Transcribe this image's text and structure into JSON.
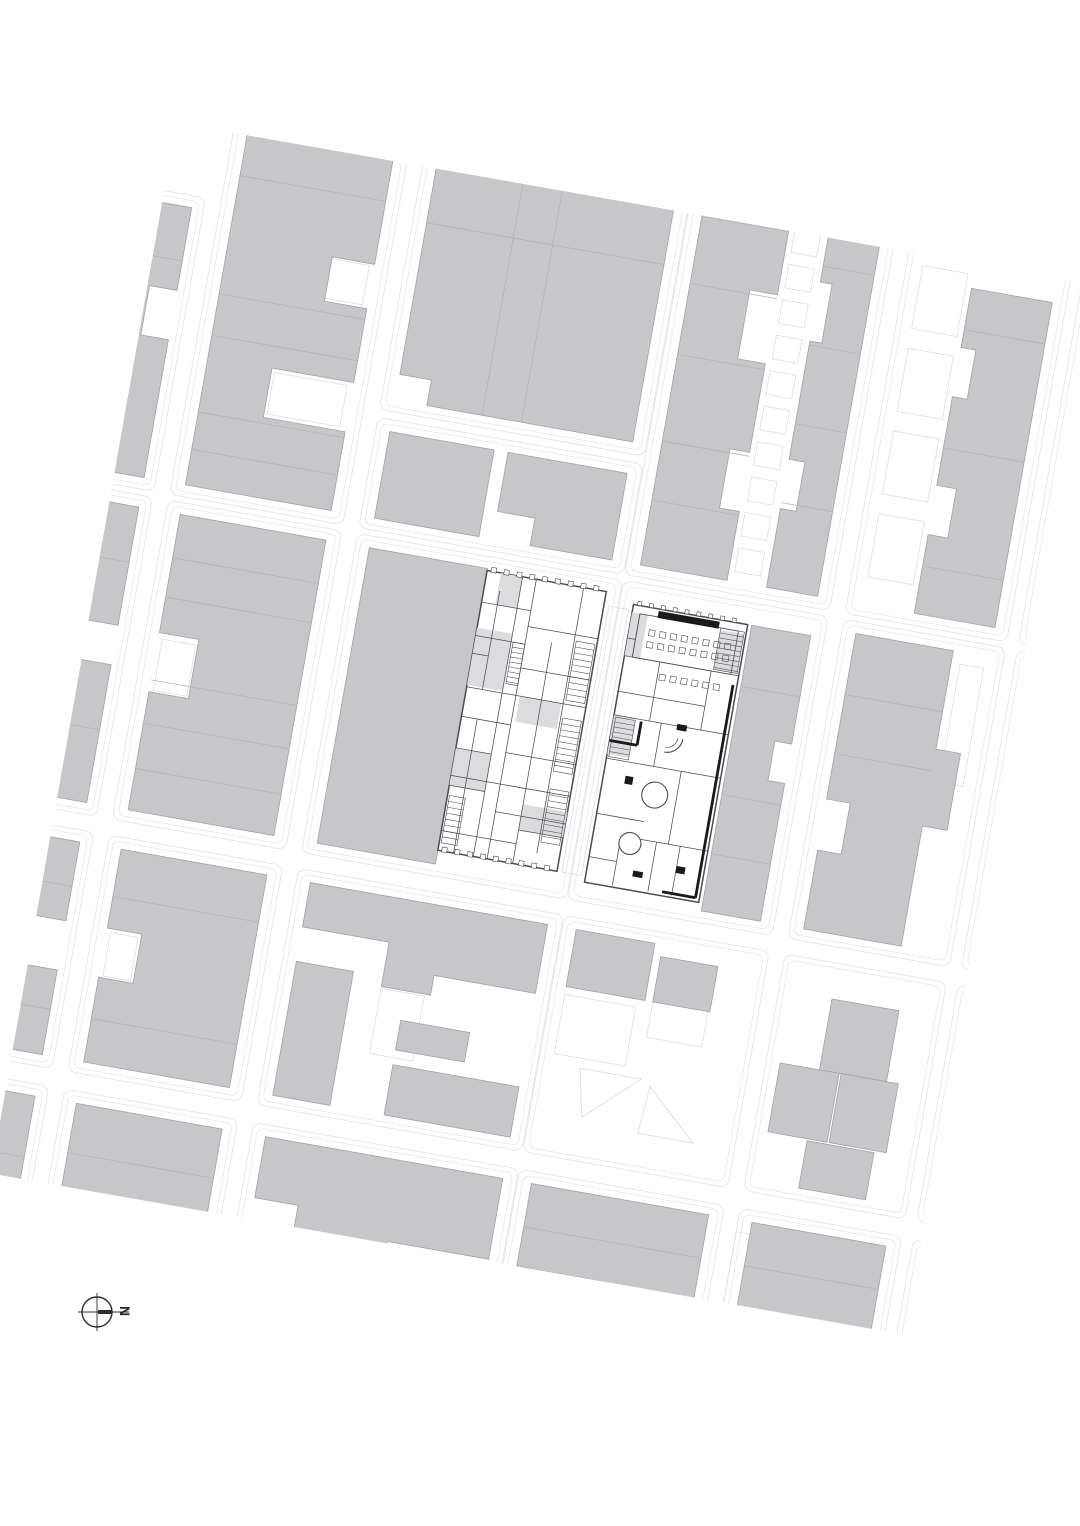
{
  "north_arrow": {
    "label": "N",
    "cx": 97,
    "cy": 1312,
    "r": 15,
    "cross_ext": 19,
    "thick_len": 15
  },
  "palette": {
    "background": "#ffffff",
    "block_fill": "#c7c7ca",
    "block_stroke": "#a2a2a8",
    "divider": "#b2b2b7",
    "street_line": "#e7e7ea",
    "parcel_line": "#dddde1",
    "plan_line": "#4b4b52",
    "plan_heavy": "#1a1a1a",
    "plan_shade": "#dcdcdf",
    "arrow": "#2e2e2e"
  },
  "map": {
    "clip": [
      78,
      195,
      928,
      1067
    ],
    "rotation": {
      "deg": 10,
      "cx": 540,
      "cy": 720
    },
    "outlines": [
      [
        -62,
        264,
        182,
        298
      ],
      [
        -62,
        568,
        182,
        324
      ],
      [
        -62,
        908,
        182,
        240
      ],
      [
        -62,
        1166,
        182,
        246
      ],
      [
        136,
        48,
        176,
        514
      ],
      [
        136,
        568,
        176,
        324
      ],
      [
        136,
        908,
        176,
        240
      ],
      [
        136,
        1166,
        176,
        246
      ],
      [
        328,
        48,
        269,
        394
      ],
      [
        328,
        450,
        269,
        112
      ],
      [
        328,
        568,
        269,
        324
      ],
      [
        328,
        908,
        269,
        240
      ],
      [
        328,
        1166,
        269,
        246
      ],
      [
        598,
        48,
        208,
        514
      ],
      [
        598,
        568,
        208,
        324
      ],
      [
        598,
        908,
        208,
        240
      ],
      [
        598,
        1166,
        208,
        246
      ],
      [
        822,
        48,
        164,
        514
      ],
      [
        822,
        568,
        164,
        324
      ],
      [
        822,
        908,
        164,
        240
      ],
      [
        822,
        1166,
        164,
        246
      ],
      [
        998,
        48,
        186,
        514
      ],
      [
        998,
        568,
        186,
        324
      ],
      [
        998,
        908,
        186,
        240
      ],
      [
        998,
        1166,
        186,
        246
      ]
    ],
    "parcels": [
      [
        233,
        302,
        60,
        40
      ],
      [
        218,
        424,
        74,
        42
      ],
      [
        154,
        706,
        34,
        52
      ],
      [
        154,
        1004,
        28,
        44
      ],
      [
        430,
        1012,
        44,
        66
      ],
      [
        588,
        596,
        20,
        270
      ],
      [
        944,
        592,
        24,
        120
      ],
      [
        1016,
        338,
        148,
        44
      ],
      [
        1012,
        766,
        96,
        108
      ],
      [
        822,
        1190,
        60,
        100
      ],
      [
        700,
        954,
        56,
        60
      ],
      [
        612,
        986,
        72,
        60
      ]
    ],
    "parcel_rows": [
      {
        "x": 706,
        "y0": 84,
        "count": 13,
        "step": 36,
        "w": 26,
        "h": 24
      },
      {
        "x": 838,
        "y0": 206,
        "count": 4,
        "step": 84,
        "w": 46,
        "h": 64
      }
    ],
    "parcel_polys": [
      "640,1056 702,1056 650,1104",
      "712,1062 764,1110 708,1110"
    ],
    "buildings": [
      "-50,276 108,276 108,360 80,360 80,410 108,410 108,550 -50,550",
      "-50,580 108,580 108,700 60,700 60,740 108,740 108,880 -50,880",
      "-50,920 108,920 108,1000 70,1000 70,1050 108,1050 108,1136 -50,1136",
      [
        -50,
        1178,
        158,
        222
      ],
      [
        150,
        60,
        148,
        110
      ],
      "150,190 298,190 298,300 255,300 255,345 298,345 298,420 215,420 215,470 298,470 298,550 150,550",
      "150,580 298,580 298,880 150,880 150,760 190,760 190,700 150,700",
      "150,920 298,920 298,1136 150,1136 150,1050 185,1050 185,1000 150,1000",
      [
        150,
        1178,
        148,
        222
      ],
      "342,60 583,60 583,430 374,430 374,404 342,404",
      [
        342,
        462,
        106,
        88
      ],
      "462,462 583,462 583,550 500,550 500,522 462,522",
      [
        342,
        580,
        120,
        300
      ],
      "342,920 583,920 583,990 480,990 480,1010 430,1010 430,965 342,965",
      [
        342,
        1000,
        58,
        136
      ],
      [
        455,
        1085,
        128,
        51
      ],
      [
        455,
        1040,
        70,
        30
      ],
      "342,1178 583,1178 583,1260 480,1260 480,1320 386,1320 386,1240 342,1240",
      [
        500,
        1298,
        83,
        102
      ],
      "612,60 700,60 700,120 680,120 680,180 700,180 700,260 672,260 672,330 700,330 700,420 680,420 680,480 700,480 700,550 612,550",
      "740,60 792,60 792,550 740,550 740,470 756,470 756,420 740,420 740,300 752,300 752,240 740,240",
      "732,590 792,590 792,700 775,700 775,740 792,740 792,880 732,880",
      [
        612,
        920,
        80,
        58
      ],
      [
        700,
        932,
        58,
        46
      ],
      "612,1178 792,1178 792,1310 700,1310 700,1262 612,1262",
      [
        648,
        1310,
        144,
        90
      ],
      [
        836,
        60,
        136,
        128
      ],
      "890,220 972,220 972,550 890,550 890,470 910,470 910,420 890,420 890,330 905,330 905,280 890,280",
      "836,580 935,580 935,680 960,680 960,758 935,758 935,880 836,880 836,800 860,800 860,748 836,748",
      [
        876,
        944,
        68,
        72
      ],
      [
        836,
        1016,
        60,
        70
      ],
      [
        898,
        1016,
        58,
        70
      ],
      [
        876,
        1088,
        68,
        48
      ],
      [
        836,
        1178,
        136,
        118
      ],
      [
        1012,
        60,
        158,
        268
      ],
      [
        1012,
        390,
        158,
        160
      ],
      [
        1012,
        580,
        110,
        178
      ],
      "1012,920 1170,920 1170,1136 1012,1136 1012,1060 1040,1060 1040,1010 1012,1010",
      [
        1040,
        1178,
        130,
        140
      ]
    ],
    "white_cuts": [
      [
        488,
        172,
        74,
        20
      ]
    ],
    "dividers": [
      [
        -50,
        330,
        108,
        330
      ],
      [
        -50,
        636,
        108,
        636
      ],
      [
        -50,
        806,
        108,
        806
      ],
      [
        -50,
        965,
        108,
        965
      ],
      [
        -50,
        1090,
        108,
        1090
      ],
      [
        -50,
        1240,
        108,
        1240
      ],
      [
        -50,
        1300,
        108,
        1300
      ],
      [
        150,
        110,
        298,
        110
      ],
      [
        150,
        152,
        298,
        152
      ],
      [
        150,
        236,
        298,
        236
      ],
      [
        150,
        356,
        298,
        356
      ],
      [
        150,
        398,
        298,
        398
      ],
      [
        150,
        476,
        298,
        476
      ],
      [
        150,
        514,
        298,
        514
      ],
      [
        150,
        624,
        298,
        624
      ],
      [
        150,
        664,
        298,
        664
      ],
      [
        150,
        748,
        298,
        748
      ],
      [
        150,
        792,
        298,
        792
      ],
      [
        150,
        838,
        298,
        838
      ],
      [
        150,
        968,
        298,
        968
      ],
      [
        150,
        1092,
        298,
        1092
      ],
      [
        150,
        1228,
        298,
        1228
      ],
      [
        150,
        1286,
        298,
        1286
      ],
      [
        430,
        60,
        430,
        430
      ],
      [
        500,
        60,
        500,
        170
      ],
      [
        470,
        196,
        470,
        430
      ],
      [
        342,
        250,
        583,
        250
      ],
      [
        612,
        152,
        700,
        152
      ],
      [
        612,
        196,
        700,
        196
      ],
      [
        612,
        264,
        700,
        264
      ],
      [
        612,
        336,
        700,
        336
      ],
      [
        612,
        424,
        700,
        424
      ],
      [
        612,
        484,
        700,
        484
      ],
      [
        740,
        140,
        792,
        140
      ],
      [
        740,
        224,
        792,
        224
      ],
      [
        740,
        304,
        792,
        304
      ],
      [
        740,
        384,
        792,
        384
      ],
      [
        740,
        464,
        792,
        464
      ],
      [
        732,
        652,
        792,
        652
      ],
      [
        732,
        762,
        792,
        762
      ],
      [
        732,
        822,
        792,
        822
      ],
      [
        612,
        1222,
        792,
        1222
      ],
      [
        890,
        262,
        972,
        262
      ],
      [
        890,
        382,
        972,
        382
      ],
      [
        890,
        502,
        972,
        502
      ],
      [
        836,
        642,
        935,
        642
      ],
      [
        836,
        702,
        935,
        702
      ],
      [
        836,
        1222,
        972,
        1222
      ],
      [
        1012,
        152,
        1170,
        152
      ],
      [
        1012,
        232,
        1170,
        232
      ],
      [
        1012,
        304,
        1170,
        304
      ],
      [
        1012,
        452,
        1170,
        452
      ],
      [
        1012,
        642,
        1122,
        642
      ],
      [
        1012,
        702,
        1122,
        702
      ],
      [
        1012,
        1002,
        1170,
        1002
      ],
      [
        1012,
        1082,
        1170,
        1082
      ]
    ],
    "plans": {
      "left": {
        "frame": [
          462,
          582,
          121,
          284
        ],
        "shades": [
          [
            462,
            640,
            36,
            58
          ],
          [
            462,
            762,
            36,
            38
          ],
          [
            516,
            700,
            42,
            26
          ],
          [
            476,
            582,
            22,
            32
          ],
          [
            538,
            806,
            45,
            26
          ]
        ],
        "lines": [
          [
            498,
            582,
            498,
            866
          ],
          [
            512,
            582,
            512,
            866
          ],
          [
            478,
            600,
            478,
            700
          ],
          [
            478,
            730,
            478,
            866
          ],
          [
            538,
            642,
            538,
            866
          ],
          [
            560,
            582,
            560,
            852
          ],
          [
            462,
            614,
            512,
            614
          ],
          [
            512,
            630,
            583,
            630
          ],
          [
            462,
            648,
            512,
            648
          ],
          [
            512,
            672,
            583,
            672
          ],
          [
            462,
            700,
            583,
            700
          ],
          [
            462,
            730,
            512,
            730
          ],
          [
            512,
            758,
            583,
            758
          ],
          [
            462,
            790,
            583,
            790
          ],
          [
            512,
            818,
            583,
            818
          ],
          [
            462,
            846,
            538,
            846
          ],
          [
            538,
            832,
            583,
            832
          ],
          [
            462,
            666,
            478,
            666
          ],
          [
            462,
            762,
            498,
            762
          ],
          [
            462,
            800,
            498,
            800
          ]
        ],
        "hatch": [
          {
            "x": 562,
            "y": 636,
            "w": 19,
            "h": 60,
            "step": 6
          },
          {
            "x": 562,
            "y": 714,
            "w": 19,
            "h": 54,
            "step": 6
          },
          {
            "x": 562,
            "y": 786,
            "w": 19,
            "h": 54,
            "step": 6
          },
          {
            "x": 500,
            "y": 648,
            "w": 12,
            "h": 42,
            "step": 5
          },
          {
            "x": 464,
            "y": 810,
            "w": 16,
            "h": 48,
            "step": 6
          }
        ],
        "ticks": [
          {
            "x0": 466,
            "y": 578,
            "count": 9,
            "step": 13,
            "size": 5
          },
          {
            "x0": 466,
            "y": 862,
            "count": 9,
            "step": 13,
            "size": 5
          }
        ]
      },
      "right": {
        "frame": [
          612,
          590,
          116,
          282
        ],
        "inner_rects": [
          [
            620,
            598,
            100,
            44
          ]
        ],
        "dark_bar": [
          638,
          592,
          62,
          7
        ],
        "seat_rows": [
          {
            "x0": 632,
            "y": 612,
            "count": 8,
            "step": 11,
            "size": 6
          },
          {
            "x0": 632,
            "y": 624,
            "count": 8,
            "step": 11,
            "size": 6
          },
          {
            "x0": 650,
            "y": 654,
            "count": 6,
            "step": 11,
            "size": 6
          }
        ],
        "shades": [
          [
            612,
            598,
            16,
            44
          ],
          [
            702,
            600,
            24,
            40
          ],
          [
            612,
            702,
            22,
            40
          ]
        ],
        "lines": [
          [
            612,
            642,
            728,
            642
          ],
          [
            648,
            642,
            648,
            702
          ],
          [
            612,
            678,
            700,
            678
          ],
          [
            700,
            642,
            700,
            702
          ],
          [
            612,
            702,
            728,
            702
          ],
          [
            660,
            702,
            660,
            746
          ],
          [
            612,
            746,
            728,
            746
          ],
          [
            688,
            746,
            688,
            820
          ],
          [
            612,
            802,
            660,
            802
          ],
          [
            660,
            820,
            728,
            820
          ],
          [
            640,
            820,
            640,
            870
          ],
          [
            612,
            846,
            640,
            846
          ],
          [
            676,
            820,
            676,
            870
          ],
          [
            700,
            820,
            700,
            870
          ],
          [
            620,
            598,
            620,
            642
          ],
          [
            612,
            624,
            620,
            624
          ]
        ],
        "heavy": [
          [
            724,
            652,
            724,
            868
          ],
          [
            640,
            704,
            640,
            728
          ],
          [
            612,
            728,
            640,
            728
          ],
          [
            690,
            868,
            724,
            868
          ]
        ],
        "circles": [
          {
            "cx": 668,
            "cy": 714,
            "r": 16,
            "quarter": true
          },
          {
            "cx": 666,
            "cy": 774,
            "r": 13
          },
          {
            "cx": 650,
            "cy": 826,
            "r": 11
          }
        ],
        "hatch": [
          {
            "x": 702,
            "y": 598,
            "w": 24,
            "h": 42,
            "step": 5
          },
          {
            "x": 614,
            "y": 704,
            "w": 20,
            "h": 40,
            "step": 5
          }
        ],
        "blacks": [
          [
            700,
            840,
            9,
            7
          ],
          [
            658,
            852,
            10,
            6
          ],
          [
            634,
            760,
            8,
            8
          ],
          [
            676,
            700,
            10,
            6
          ]
        ],
        "ticks": [
          {
            "x0": 616,
            "y": 586,
            "count": 9,
            "step": 12,
            "size": 4
          }
        ]
      }
    }
  }
}
